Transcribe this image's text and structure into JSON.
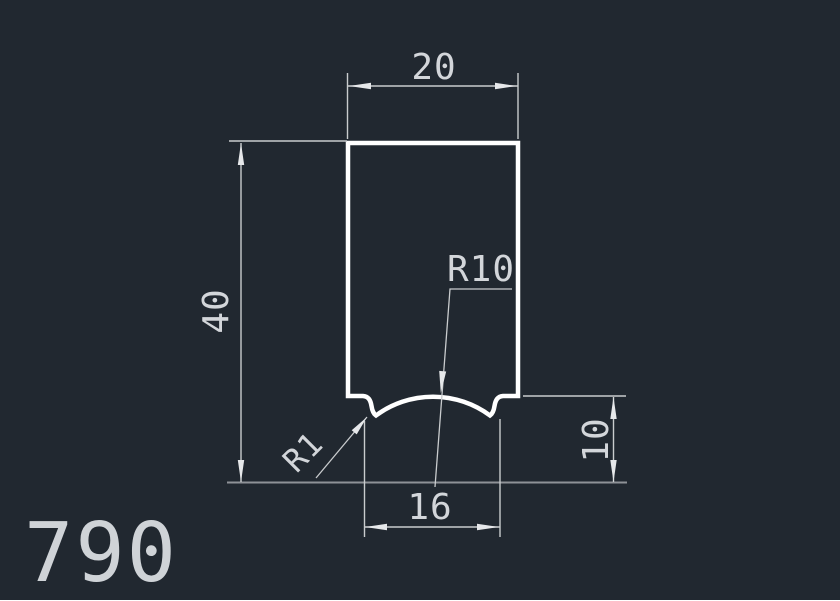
{
  "drawing": {
    "part_label": "790",
    "dimensions": {
      "top_width": "20",
      "overall_height": "40",
      "groove_width": "16",
      "shoulder_height": "10",
      "groove_radius": "R10",
      "fillet_radius": "R1"
    },
    "colors": {
      "background": "#212830",
      "profile_stroke": "#ffffff",
      "dimension_stroke": "#c9ccce",
      "baseline_stroke": "#8e9297",
      "text_color": "#d3d6da"
    }
  }
}
